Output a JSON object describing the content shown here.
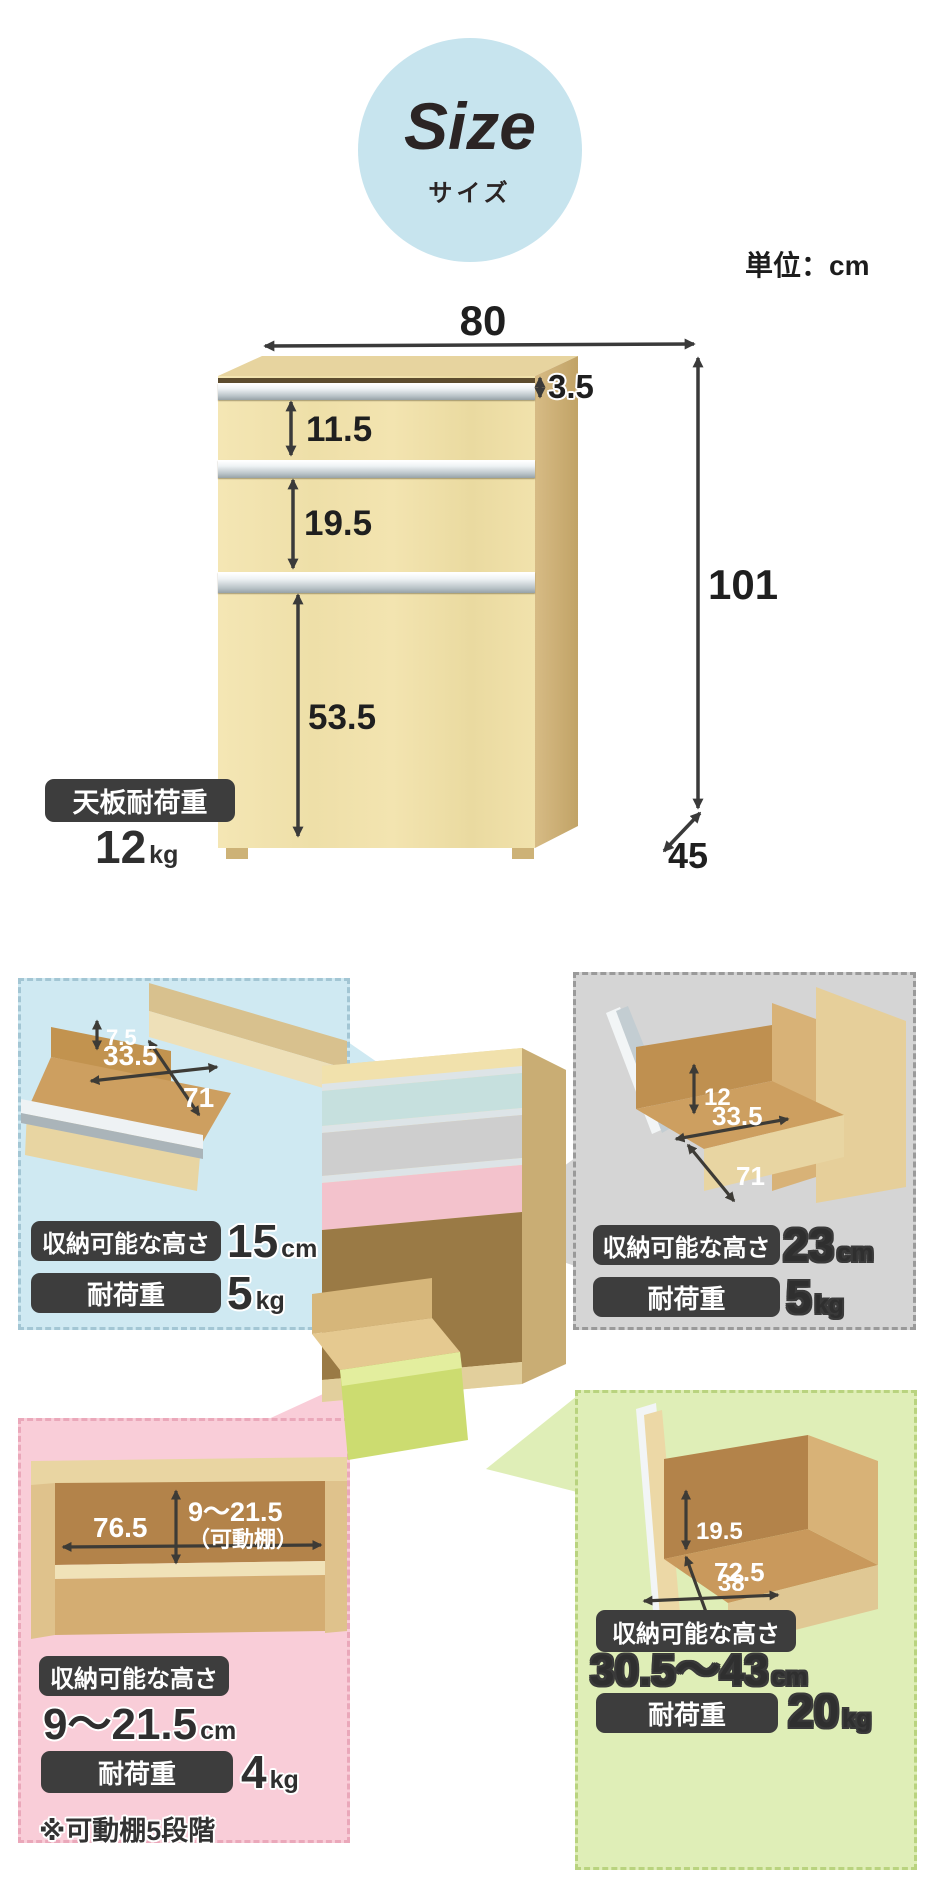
{
  "header": {
    "badge": {
      "title": "Size",
      "subtitle": "サイズ",
      "bg": "#c7e4ee"
    },
    "unit_note": "単位：cm"
  },
  "main_diagram": {
    "overall": {
      "width": "80",
      "height": "101",
      "depth": "45"
    },
    "segments": {
      "top_gap": "3.5",
      "drawer1": "11.5",
      "drawer2": "19.5",
      "drawer3": "53.5"
    },
    "top_load": {
      "label": "天板耐荷重",
      "value": "12",
      "unit": "kg"
    }
  },
  "panels": {
    "top_left": {
      "accent": "#cfe9f2",
      "dims": {
        "clearance": "7.5",
        "inner_depth": "33.5",
        "inner_width": "71"
      },
      "rows": [
        {
          "label": "収納可能な高さ",
          "value": "15",
          "unit": "cm"
        },
        {
          "label": "耐荷重",
          "value": "5",
          "unit": "kg"
        }
      ]
    },
    "top_right": {
      "accent": "#d5d5d5",
      "dims": {
        "clearance": "12",
        "inner_depth": "33.5",
        "inner_width": "71"
      },
      "rows": [
        {
          "label": "収納可能な高さ",
          "value": "23",
          "unit": "cm"
        },
        {
          "label": "耐荷重",
          "value": "5",
          "unit": "kg"
        }
      ]
    },
    "bottom_left": {
      "accent": "#f9cdd8",
      "dims": {
        "inner_width": "76.5",
        "height_range": "9～21.5",
        "height_note": "（可動棚）"
      },
      "rows": [
        {
          "label": "収納可能な高さ",
          "value": "9～21.5",
          "unit": "cm"
        },
        {
          "label": "耐荷重",
          "value": "4",
          "unit": "kg"
        }
      ],
      "footnote": "※可動棚5段階"
    },
    "bottom_right": {
      "accent": "#dfeeb7",
      "dims": {
        "clearance": "19.5",
        "inner_depth": "72.5",
        "inner_width": "38"
      },
      "rows": [
        {
          "label": "収納可能な高さ",
          "value": "30.5～43",
          "unit": "cm"
        },
        {
          "label": "耐荷重",
          "value": "20",
          "unit": "kg"
        }
      ]
    }
  }
}
